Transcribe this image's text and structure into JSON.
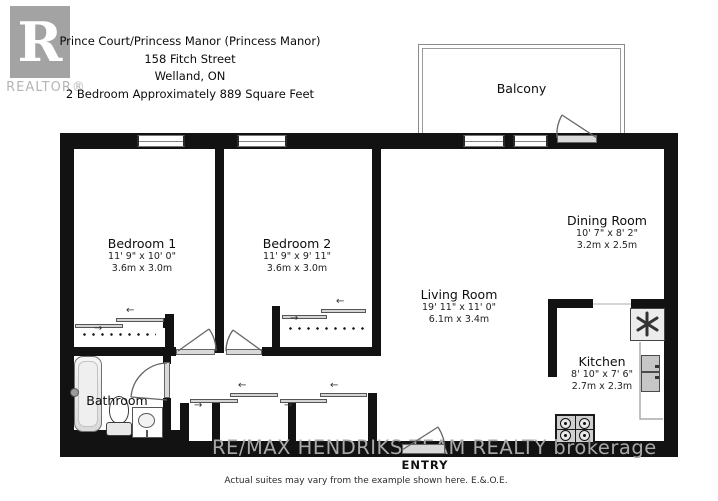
{
  "header": {
    "logo_r": "R",
    "logo_label": "REALTOR®",
    "title_lines": [
      "Prince Court/Princess Manor (Princess Manor)",
      "158 Fitch Street",
      "Welland, ON",
      "2 Bedroom Approximately 889 Square Feet"
    ]
  },
  "rooms": {
    "bedroom1": {
      "name": "Bedroom 1",
      "dim_ft": "11' 9\" x 10' 0\"",
      "dim_m": "3.6m x 3.0m"
    },
    "bedroom2": {
      "name": "Bedroom 2",
      "dim_ft": "11' 9\" x 9' 11\"",
      "dim_m": "3.6m x 3.0m"
    },
    "living": {
      "name": "Living Room",
      "dim_ft": "19' 11\" x 11' 0\"",
      "dim_m": "6.1m x 3.4m"
    },
    "dining": {
      "name": "Dining Room",
      "dim_ft": "10' 7\" x 8' 2\"",
      "dim_m": "3.2m x 2.5m"
    },
    "kitchen": {
      "name": "Kitchen",
      "dim_ft": "8' 10\" x 7' 6\"",
      "dim_m": "2.7m x 2.3m"
    },
    "bathroom": {
      "name": "Bathroom"
    },
    "balcony": {
      "name": "Balcony"
    }
  },
  "labels": {
    "entry": "ENTRY"
  },
  "watermark": "RE/MAX  HENDRIKS TEAM REALTY brokerage",
  "disclaimer": "Actual suites may vary from the example shown here. E.&.O.E.",
  "icons": {
    "arrow_left": "←",
    "arrow_right": "→"
  },
  "colors": {
    "wall": "#121212",
    "fixture_gray": "#d9d9d9",
    "watermark_gray": "#a9a9a9"
  }
}
